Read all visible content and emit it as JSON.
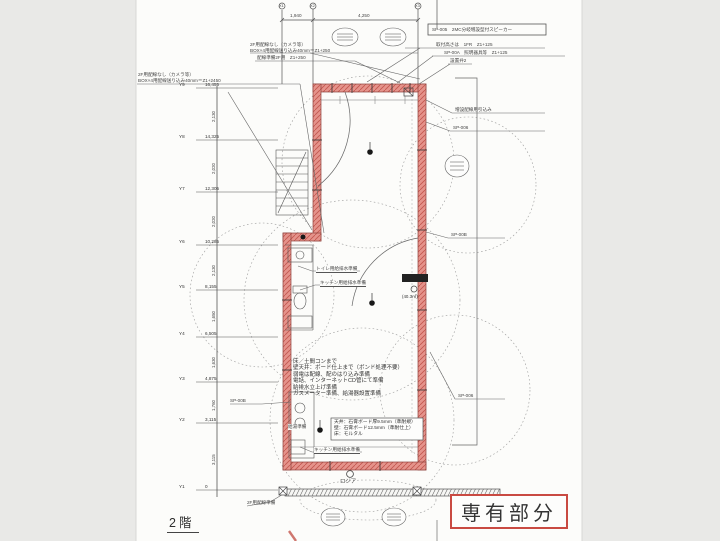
{
  "page": {
    "floor_label": "2階"
  },
  "stamp": {
    "label": "専有部分",
    "border_color": "#c94a42"
  },
  "colors": {
    "highlight_red": "#e5938b",
    "stamp_red": "#c94a42",
    "ink": "#4a4a4a",
    "paper": "#fcfcfa",
    "scan_bg": "#e9e9e7"
  },
  "dims": {
    "top_left": "1,940",
    "top_right": "4,250"
  },
  "x_grid": [
    "X1",
    "X2",
    "X3"
  ],
  "grid": {
    "rows": [
      {
        "label": "Y9",
        "elev": "16,455",
        "y": 88,
        "dim": "2,130"
      },
      {
        "label": "Y8",
        "elev": "14,325",
        "y": 140,
        "dim": "2,020"
      },
      {
        "label": "Y7",
        "elev": "12,305",
        "y": 192,
        "dim": "2,020"
      },
      {
        "label": "Y6",
        "elev": "10,285",
        "y": 245,
        "dim": "2,130"
      },
      {
        "label": "Y5",
        "elev": "8,155",
        "y": 290,
        "dim": "1,650"
      },
      {
        "label": "Y4",
        "elev": "6,505",
        "y": 337,
        "dim": "1,630"
      },
      {
        "label": "Y3",
        "elev": "4,875",
        "y": 382,
        "dim": "1,760"
      },
      {
        "label": "Y2",
        "elev": "3,115",
        "y": 423,
        "dim": "3,115"
      },
      {
        "label": "Y1",
        "elev": "0",
        "y": 490,
        "dim": ""
      }
    ]
  },
  "ann": {
    "tl1a": "2F用配線なし（カメラ等）",
    "tl1b": "BOX×4用配線送り込み40mm＝Z1+250",
    "tl2": "配線準備2F用　Z1+250",
    "tl3a": "2F用配線なし（カメラ等）",
    "tl3b": "BOX×4用配線送り込み40mm＝Z1+2450",
    "tr_box": "SP-005　2MC分岐増設型付スピーカー",
    "tr1": "取付高さは　1FR　Z1+125",
    "tr2": "SP-00A　照明器具等　Z1+125",
    "tr3": "設置弁2",
    "r1": "増設配線用引込み",
    "r2": "SP-006",
    "r3": "SP-00B",
    "r4": "SP-006",
    "l1": "SP-00B",
    "bl1": "2F用配線準備",
    "toilet": "トイレ用給排水準備",
    "kitchen1": "キッチン用給排水準備",
    "kitchen2": "キッチン用給排水準備",
    "hotwater": "給湯準備",
    "loggia": "ロジア",
    "area": "(40.3㎡)"
  },
  "notes": [
    "床／土間コンまで",
    "壁天井：ボード仕上まで（ボンド処理不要）",
    "弱電は配線、配のはり込み準備",
    "電話、インターネットCD管にて準備",
    "給排水立上げ準備",
    "ガスメーター準備、給湯器設置準備"
  ],
  "spec_box": [
    "天井：石膏ボード厚9.5mm（準耐規）",
    "壁：石膏ボード12.5mm（準耐仕上）",
    "床：モルタル"
  ]
}
